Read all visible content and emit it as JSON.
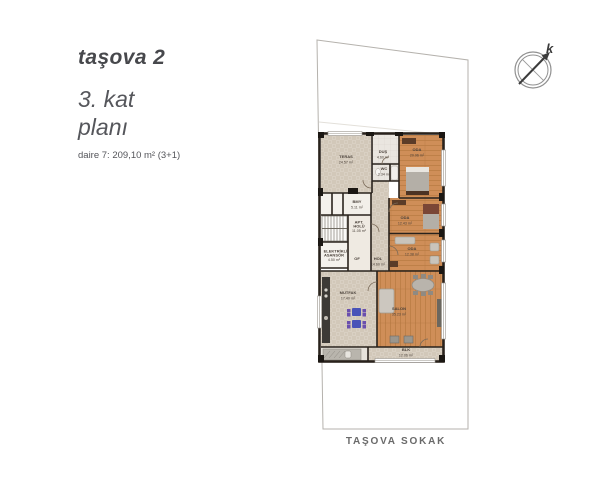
{
  "header": {
    "title": "taşova 2",
    "subtitle_line1": "3. kat",
    "subtitle_line2": "planı",
    "apartment_info": "daire 7: 209,10 m² (3+1)"
  },
  "compass": {
    "north_label": "k"
  },
  "street_label": "TAŞOVA SOKAK",
  "floor_plan": {
    "rooms": [
      {
        "name": "TERAS",
        "area": "24.57 m²"
      },
      {
        "name": "DUŞ",
        "area": "4.60 m²"
      },
      {
        "name": "WC",
        "area": "2.34 m²"
      },
      {
        "name": "ODA",
        "area": "20.96 m²"
      },
      {
        "name": "BMY",
        "area": "5.11 m²"
      },
      {
        "name": "APT. HOLÜ",
        "area": "11.05 m²"
      },
      {
        "name": "ELEKTRİKLİ ASANSÖR",
        "area": "4.50 m²"
      },
      {
        "name": "OF",
        "area": ""
      },
      {
        "name": "HOL",
        "area": "14.60 m²"
      },
      {
        "name": "ODA",
        "area": "12.43 m²"
      },
      {
        "name": "ODA",
        "area": "12.38 m²"
      },
      {
        "name": "MUTFAK",
        "area": "17.40 m²"
      },
      {
        "name": "SALON",
        "area": "35.23 m²"
      },
      {
        "name": "BLK",
        "area": "12.06 m²"
      }
    ]
  },
  "colors": {
    "wood_floor": "#cf8e58",
    "wood_line": "#b5783f",
    "stone_floor": "#d9d0c3",
    "tile_floor": "#eae6e0",
    "wall": "#29221c",
    "pier_black": "#1b1713",
    "title_text": "#47484c",
    "street_text": "#6a6a6a",
    "parcel_line": "#b5b2ad",
    "kitchen_table_blue": "#4953b8",
    "kitchen_chair_purple": "#6a4fae"
  }
}
